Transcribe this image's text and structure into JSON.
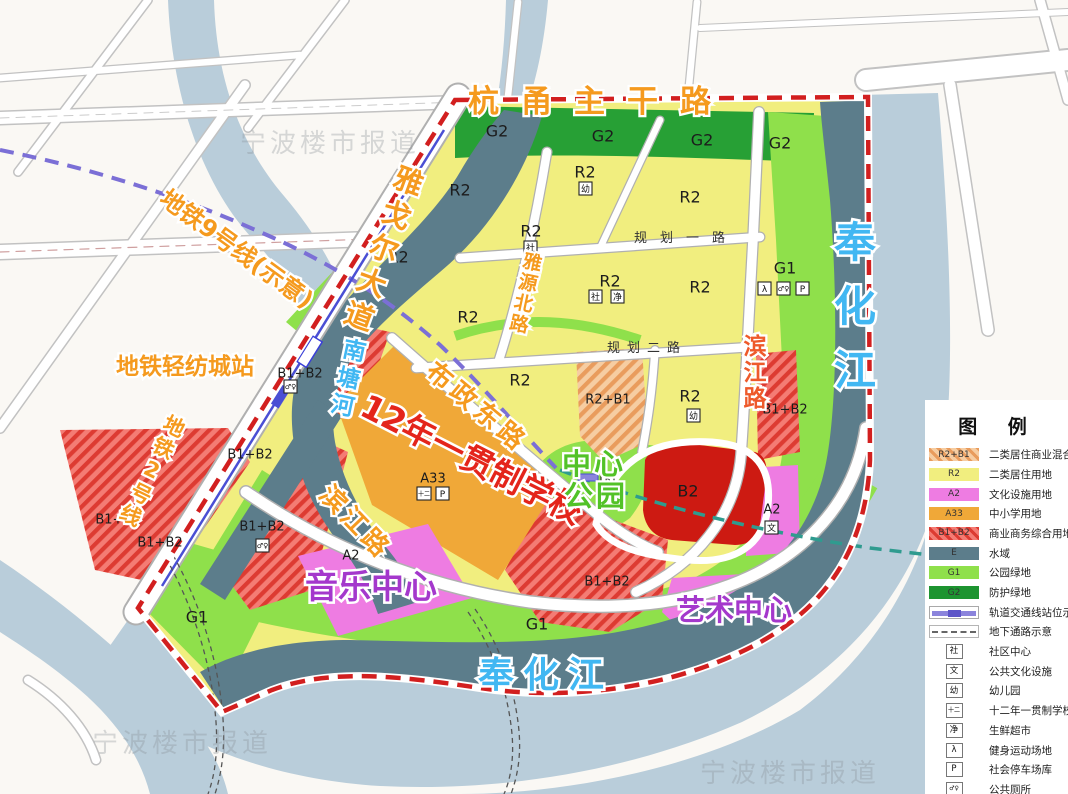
{
  "map_labels": {
    "hangyong_road": "杭甬主干路",
    "yageer_avenue": "雅戈尔大道",
    "metro9_line": "地铁9号线(示意)",
    "qingfangcheng_station": "地铁轻纺城站",
    "metro2_line": "地铁2号线",
    "buzheng_east_road": "布政东路",
    "binjiang_road": "滨江路",
    "yayuan_north_road": "雅源北路",
    "guihua_road_1": "规划一路",
    "guihua_road_2": "规划二路",
    "nantang_river": "南塘河",
    "fenghua_river": "奉化江",
    "school_12yr": "12年一贯制学校",
    "music_center": "音乐中心",
    "art_center": "艺术中心",
    "central_park_l1": "中心",
    "central_park_l2": "公园"
  },
  "zone_codes": {
    "r2": "R2",
    "g1": "G1",
    "g2": "G2",
    "b2": "B2",
    "a2": "A2",
    "a33": "A33",
    "b1b2": "B1+B2",
    "r2b1": "R2+B1"
  },
  "symbols": {
    "you": "幼",
    "she": "社",
    "jing": "净",
    "wen": "文",
    "twelve": "十二",
    "parking": "P"
  },
  "watermark": "宁波楼市报道",
  "colors": {
    "residential_r2": "#f1ee7f",
    "buffer_green_g2": "#27a035",
    "park_green_g1": "#8fe04b",
    "water_e": "#5c7d8b",
    "outer_river": "#b9cdda",
    "culture_a2": "#ee7ce2",
    "school_a33": "#f0a838",
    "commercial_b2": "#cd1a12",
    "boundary_red": "#d21f1f",
    "metro_purple": "#7b6fd6",
    "road_label_orange": "#f59a1e",
    "river_label_blue": "#41b7f2"
  },
  "legend": {
    "title": "图  例",
    "rows": [
      {
        "type": "hatch-orange",
        "code": "R2+B1",
        "label": "二类居住商业混合用地"
      },
      {
        "type": "fill",
        "color": "#f1ee7f",
        "code": "R2",
        "label": "二类居住用地"
      },
      {
        "type": "fill",
        "color": "#ee7ce2",
        "code": "A2",
        "label": "文化设施用地"
      },
      {
        "type": "fill",
        "color": "#f0a838",
        "code": "A33",
        "label": "中小学用地"
      },
      {
        "type": "hatch-red",
        "code": "B1+B2",
        "label": "商业商务综合用地"
      },
      {
        "type": "fill",
        "color": "#5c7d8b",
        "code": "E",
        "label": "水域"
      },
      {
        "type": "fill",
        "color": "#8fe04b",
        "code": "G1",
        "label": "公园绿地"
      },
      {
        "type": "fill",
        "color": "#1d9430",
        "code": "G2",
        "label": "防护绿地"
      },
      {
        "type": "metro",
        "code": "",
        "label": "轨道交通线站位示意"
      },
      {
        "type": "dashed",
        "code": "",
        "label": "地下通路示意"
      },
      {
        "type": "icon",
        "code": "社",
        "label": "社区中心"
      },
      {
        "type": "icon",
        "code": "文",
        "label": "公共文化设施"
      },
      {
        "type": "icon",
        "code": "幼",
        "label": "幼儿园"
      },
      {
        "type": "icon",
        "code": "十二",
        "label": "十二年一贯制学校"
      },
      {
        "type": "icon",
        "code": "净",
        "label": "生鲜超市"
      },
      {
        "type": "icon",
        "code": "λ",
        "label": "健身运动场地"
      },
      {
        "type": "icon",
        "code": "P",
        "label": "社会停车场库"
      },
      {
        "type": "icon",
        "code": "♂♀",
        "label": "公共厕所"
      }
    ]
  }
}
